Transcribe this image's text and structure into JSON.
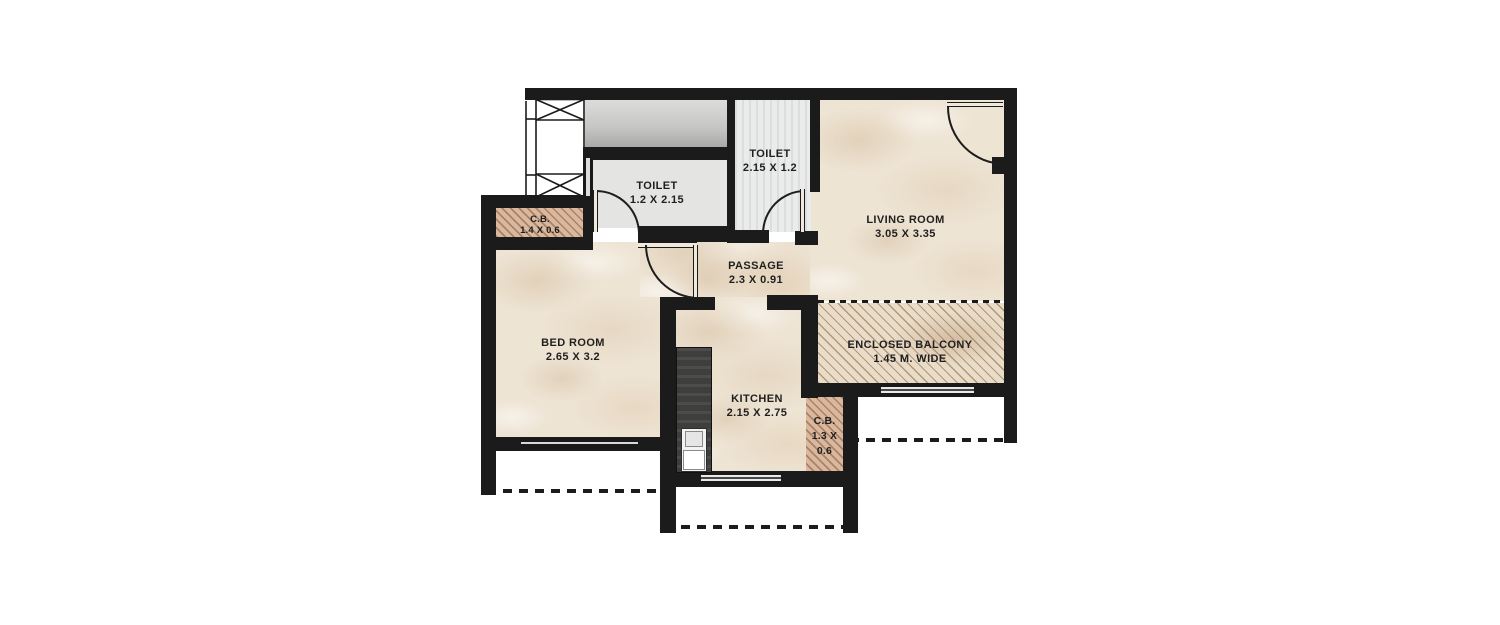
{
  "plan": {
    "rooms": [
      {
        "id": "toilet-1",
        "label": "TOILET",
        "dims": "1.2 X 2.15"
      },
      {
        "id": "toilet-2",
        "label": "TOILET",
        "dims": "2.15 X 1.2"
      },
      {
        "id": "living-room",
        "label": "LIVING ROOM",
        "dims": "3.05 X 3.35"
      },
      {
        "id": "cb-top",
        "label": "C.B.",
        "dims": "1.4 X 0.6"
      },
      {
        "id": "passage",
        "label": "PASSAGE",
        "dims": "2.3 X 0.91"
      },
      {
        "id": "bed-room",
        "label": "BED ROOM",
        "dims": "2.65 X 3.2"
      },
      {
        "id": "kitchen",
        "label": "KITCHEN",
        "dims": "2.15 X 2.75"
      },
      {
        "id": "cb-right",
        "label": "C.B.",
        "dims": "1.3 X",
        "dims2": "0.6"
      },
      {
        "id": "enclosed-balcony",
        "label": "ENCLOSED BALCONY",
        "dims": "1.45 M. WIDE"
      }
    ],
    "colors": {
      "wall": "#1b1b1b",
      "line": "#1d1d1d",
      "marble": "#eee4d4",
      "toilet1-floor": "#e4e5e3",
      "toilet2-floor": "#eaebeb",
      "lobby-top": "#dcdcda",
      "lobby-bottom": "#a4a4a2",
      "cb-hatch-base": "#d9b89e",
      "cb-hatch-line": "#aa8169",
      "balcony-base": "#e9dcc8",
      "balcony-line": "#b09878",
      "platform": "#3e3e3c"
    }
  }
}
